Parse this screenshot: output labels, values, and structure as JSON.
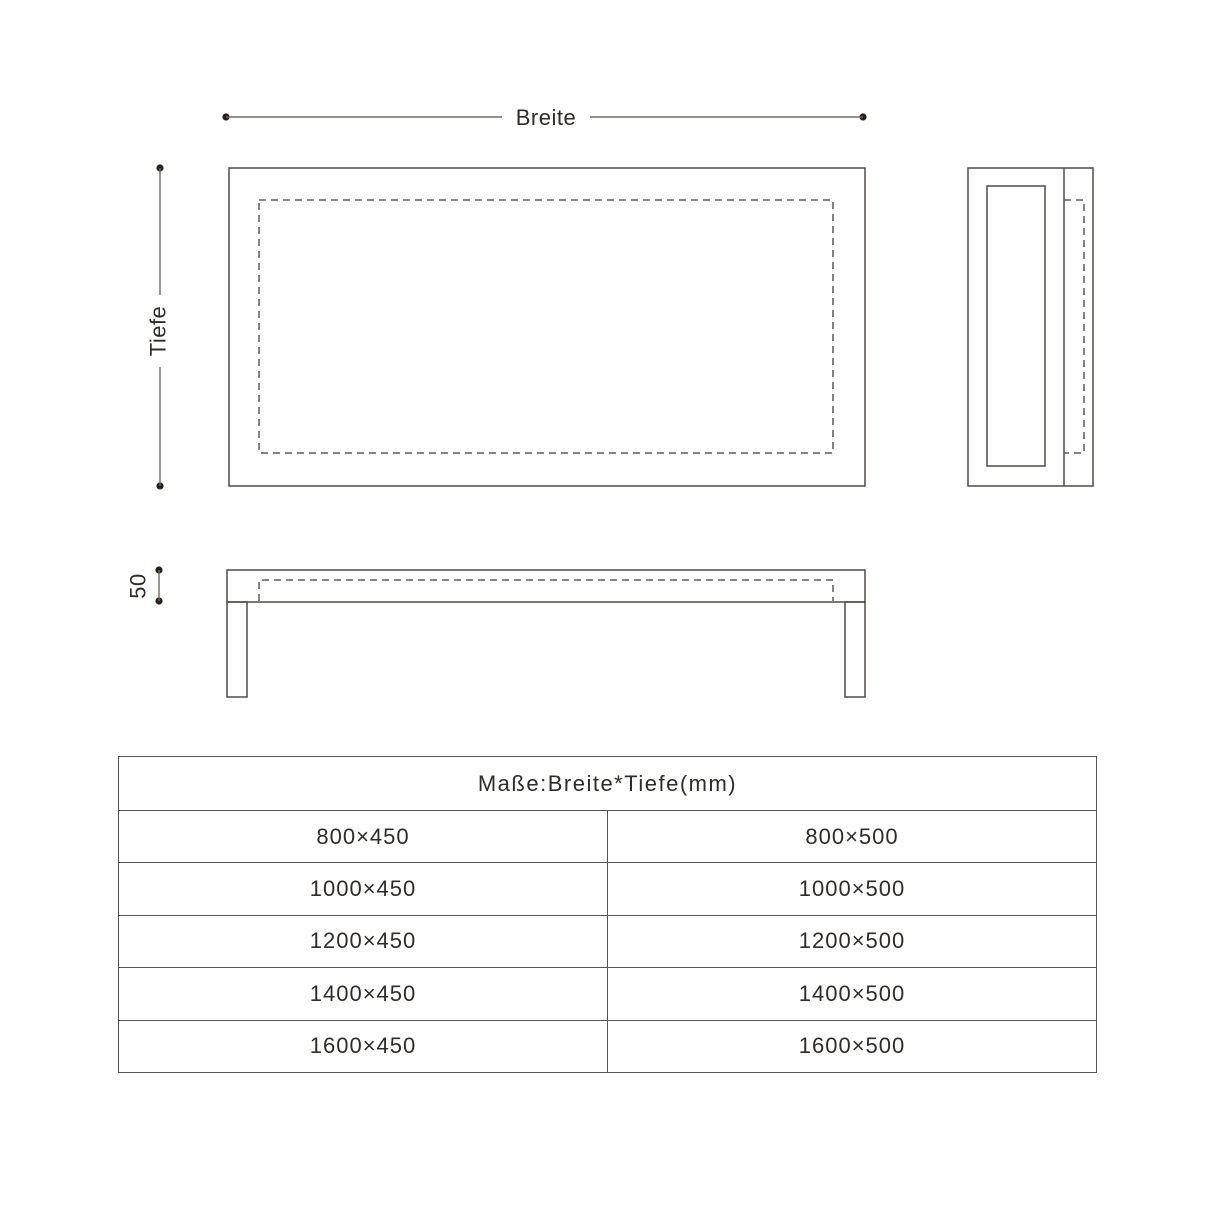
{
  "diagram": {
    "breite_label": "Breite",
    "tiefe_label": "Tiefe",
    "height_label": "50"
  },
  "table": {
    "header": "Maße:Breite*Tiefe(mm)",
    "rows": [
      [
        "800×450",
        "800×500"
      ],
      [
        "1000×450",
        "1000×500"
      ],
      [
        "1200×450",
        "1200×500"
      ],
      [
        "1400×450",
        "1400×500"
      ],
      [
        "1600×450",
        "1600×500"
      ]
    ]
  },
  "colors": {
    "line": "#4f4b49",
    "dash": "#5d5956",
    "dim_line": "#6e6a67",
    "dot": "#2a1e16",
    "text": "#2f2c2a",
    "table_border": "#575350",
    "background": "#ffffff"
  }
}
